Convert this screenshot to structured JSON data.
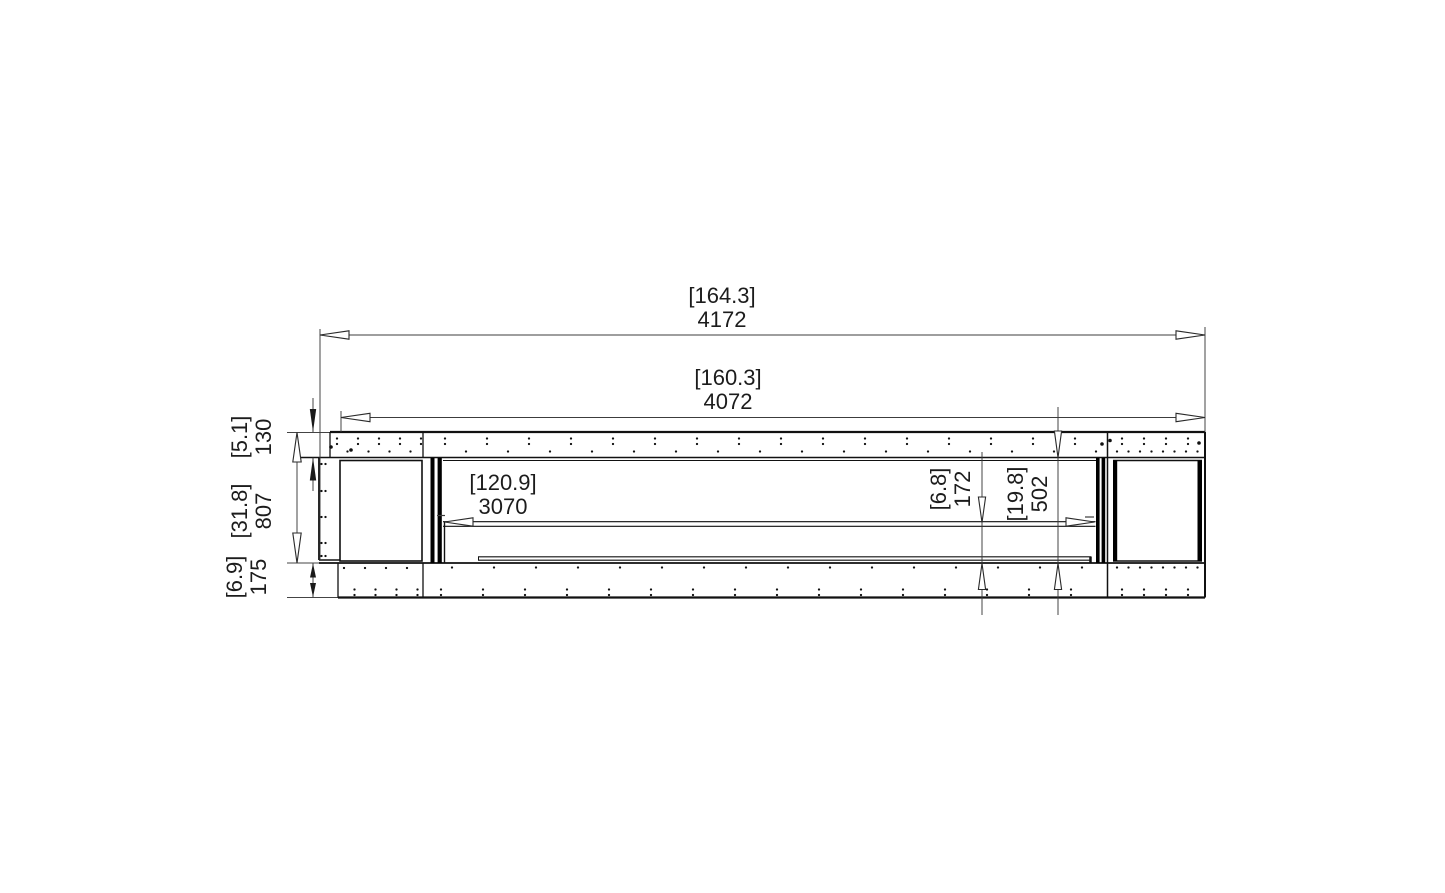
{
  "drawing": {
    "type": "fireplace-front-elevation-dimension-drawing",
    "dims": {
      "overall_width": {
        "inches": "[164.3]",
        "mm": "4172"
      },
      "inner_width": {
        "inches": "[160.3]",
        "mm": "4072"
      },
      "top_panel_height": {
        "inches": "[5.1]",
        "mm": "130"
      },
      "body_height": {
        "inches": "[31.8]",
        "mm": "807"
      },
      "base_height": {
        "inches": "[6.9]",
        "mm": "175"
      },
      "burner_width": {
        "inches": "[120.9]",
        "mm": "3070"
      },
      "burner_to_floor": {
        "inches": "[6.8]",
        "mm": "172"
      },
      "opening_height": {
        "inches": "[19.8]",
        "mm": "502"
      }
    },
    "colors": {
      "background": "#ffffff",
      "outline": "#111111",
      "dimension_line": "#3c3c3c",
      "dot": "#111111"
    }
  }
}
